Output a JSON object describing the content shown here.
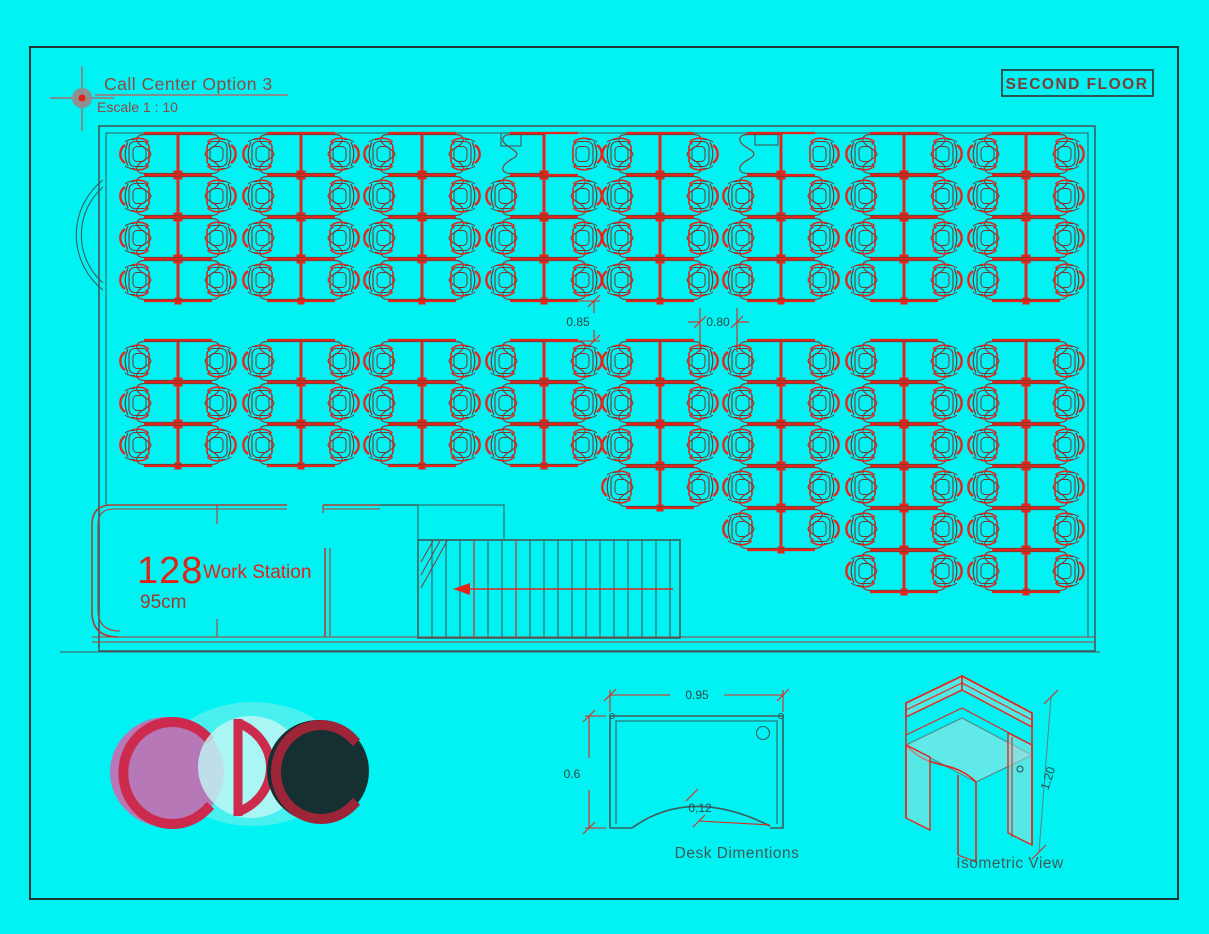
{
  "colors": {
    "background": "#00f2f2",
    "frame": "#1d3737",
    "wall": "#3e5c5c",
    "red_wall": "#b23c32",
    "red": "#e8241a",
    "desk": "#8a3a30",
    "chair_dark": "#79352e",
    "dim_text": "#2f4747",
    "title_text": "#8d4a42",
    "big_red": "#e02317",
    "caption_text": "#3f5a5a",
    "logo_purple": "#b678b6",
    "logo_red": "#cc2b4d",
    "logo_dark": "#143030",
    "logo_dark_red": "#9e2438"
  },
  "title": {
    "main": "Call Center Option 3",
    "scale": "Escale 1 : 10"
  },
  "floor_label": "SECOND FLOOR",
  "plan": {
    "workstation_count": "128",
    "workstation_label": "Work Station",
    "desk_height_label": "95cm",
    "dim_vertical": "0.85",
    "dim_horizontal": "0.80",
    "row_height": 42,
    "columns": [
      {
        "cx": 178,
        "top": 133,
        "rows": 4,
        "skip": []
      },
      {
        "cx": 301,
        "top": 133,
        "rows": 4,
        "skip": []
      },
      {
        "cx": 422,
        "top": 133,
        "rows": 4,
        "skip": []
      },
      {
        "cx": 544,
        "top": 133,
        "rows": 4,
        "skip": [
          [
            0,
            "L"
          ]
        ]
      },
      {
        "cx": 660,
        "top": 133,
        "rows": 4,
        "skip": []
      },
      {
        "cx": 781,
        "top": 133,
        "rows": 4,
        "skip": [
          [
            0,
            "L"
          ]
        ]
      },
      {
        "cx": 904,
        "top": 133,
        "rows": 4,
        "skip": []
      },
      {
        "cx": 1026,
        "top": 133,
        "rows": 4,
        "skip": []
      },
      {
        "cx": 178,
        "top": 340,
        "rows": 3,
        "skip": []
      },
      {
        "cx": 301,
        "top": 340,
        "rows": 3,
        "skip": []
      },
      {
        "cx": 422,
        "top": 340,
        "rows": 3,
        "skip": []
      },
      {
        "cx": 544,
        "top": 340,
        "rows": 3,
        "skip": []
      },
      {
        "cx": 660,
        "top": 340,
        "rows": 4,
        "skip": []
      },
      {
        "cx": 781,
        "top": 340,
        "rows": 5,
        "skip": []
      },
      {
        "cx": 904,
        "top": 340,
        "rows": 6,
        "skip": []
      },
      {
        "cx": 1026,
        "top": 340,
        "rows": 6,
        "skip": []
      }
    ]
  },
  "desk_detail": {
    "width": "0.95",
    "depth": "0.6",
    "curve": "0,12",
    "caption": "Desk Dimentions"
  },
  "isometric": {
    "height": "1.20",
    "caption": "Isometric View"
  },
  "logo": {
    "text": "CDC"
  }
}
